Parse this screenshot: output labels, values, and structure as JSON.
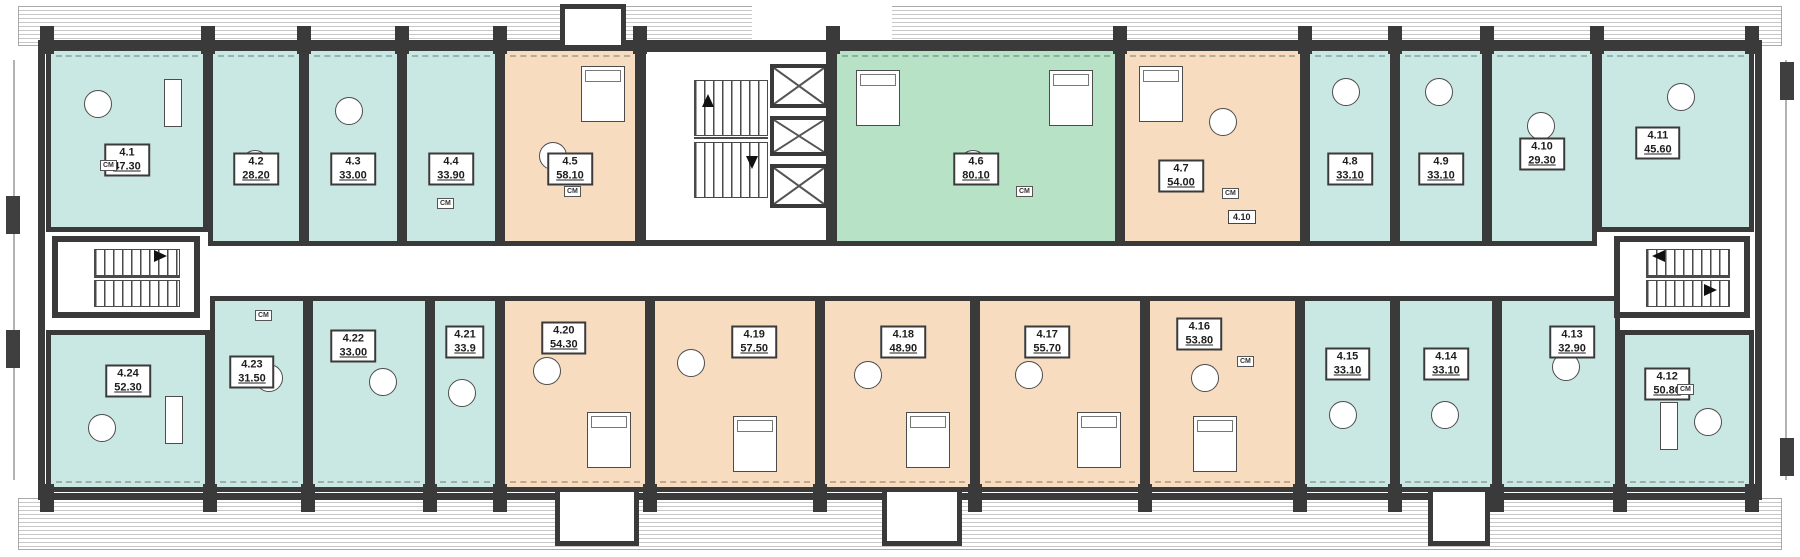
{
  "colors": {
    "teal": "#c9e7e3",
    "peach": "#f7dcbf",
    "green": "#b7e2c6",
    "wall": "#3a3a3a"
  },
  "labels": {
    "washing_machine": "СМ",
    "annex_unit": "4.10"
  },
  "units": [
    {
      "id": "4.1",
      "area": "47.30",
      "fill": "teal"
    },
    {
      "id": "4.2",
      "area": "28.20",
      "fill": "teal"
    },
    {
      "id": "4.3",
      "area": "33.00",
      "fill": "teal"
    },
    {
      "id": "4.4",
      "area": "33.90",
      "fill": "teal"
    },
    {
      "id": "4.5",
      "area": "58.10",
      "fill": "peach"
    },
    {
      "id": "4.6",
      "area": "80.10",
      "fill": "green"
    },
    {
      "id": "4.7",
      "area": "54.00",
      "fill": "peach"
    },
    {
      "id": "4.8",
      "area": "33.10",
      "fill": "teal"
    },
    {
      "id": "4.9",
      "area": "33.10",
      "fill": "teal"
    },
    {
      "id": "4.10",
      "area": "29.30",
      "fill": "teal"
    },
    {
      "id": "4.11",
      "area": "45.60",
      "fill": "teal"
    },
    {
      "id": "4.12",
      "area": "50.80",
      "fill": "teal"
    },
    {
      "id": "4.13",
      "area": "32.90",
      "fill": "teal"
    },
    {
      "id": "4.14",
      "area": "33.10",
      "fill": "teal"
    },
    {
      "id": "4.15",
      "area": "33.10",
      "fill": "teal"
    },
    {
      "id": "4.16",
      "area": "53.80",
      "fill": "peach"
    },
    {
      "id": "4.17",
      "area": "55.70",
      "fill": "peach"
    },
    {
      "id": "4.18",
      "area": "48.90",
      "fill": "peach"
    },
    {
      "id": "4.19",
      "area": "57.50",
      "fill": "peach"
    },
    {
      "id": "4.20",
      "area": "54.30",
      "fill": "peach"
    },
    {
      "id": "4.21",
      "area": "33.9",
      "fill": "teal"
    },
    {
      "id": "4.22",
      "area": "33.00",
      "fill": "teal"
    },
    {
      "id": "4.23",
      "area": "31.50",
      "fill": "teal"
    },
    {
      "id": "4.24",
      "area": "52.30",
      "fill": "teal"
    }
  ]
}
